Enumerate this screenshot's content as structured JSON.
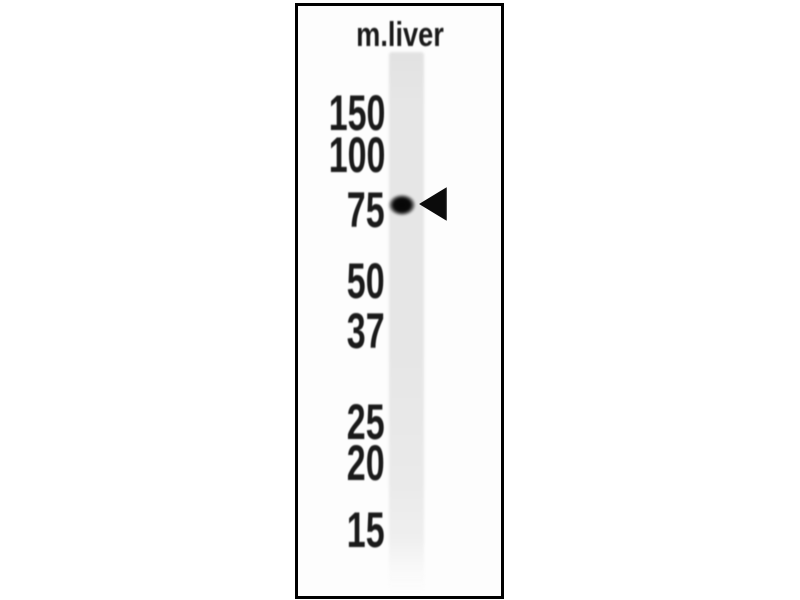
{
  "blot": {
    "lane_label": "m.liver",
    "ladder_markers": [
      {
        "label": "150",
        "y": 113
      },
      {
        "label": "100",
        "y": 155
      },
      {
        "label": "75",
        "y": 210
      },
      {
        "label": "50",
        "y": 281
      },
      {
        "label": "37",
        "y": 331
      },
      {
        "label": "25",
        "y": 422
      },
      {
        "label": "20",
        "y": 463
      },
      {
        "label": "15",
        "y": 530
      }
    ],
    "band": {
      "aligned_marker": "75",
      "y": 205
    },
    "arrow_icon": {
      "points": "left",
      "y": 204
    },
    "colors": {
      "background": "#ffffff",
      "panel": "#fdfdfd",
      "border": "#000000",
      "lane": "#e6e6e6",
      "band": "#0a0a0a",
      "arrow": "#0b0b0b",
      "text": "#1a1a1a"
    }
  }
}
